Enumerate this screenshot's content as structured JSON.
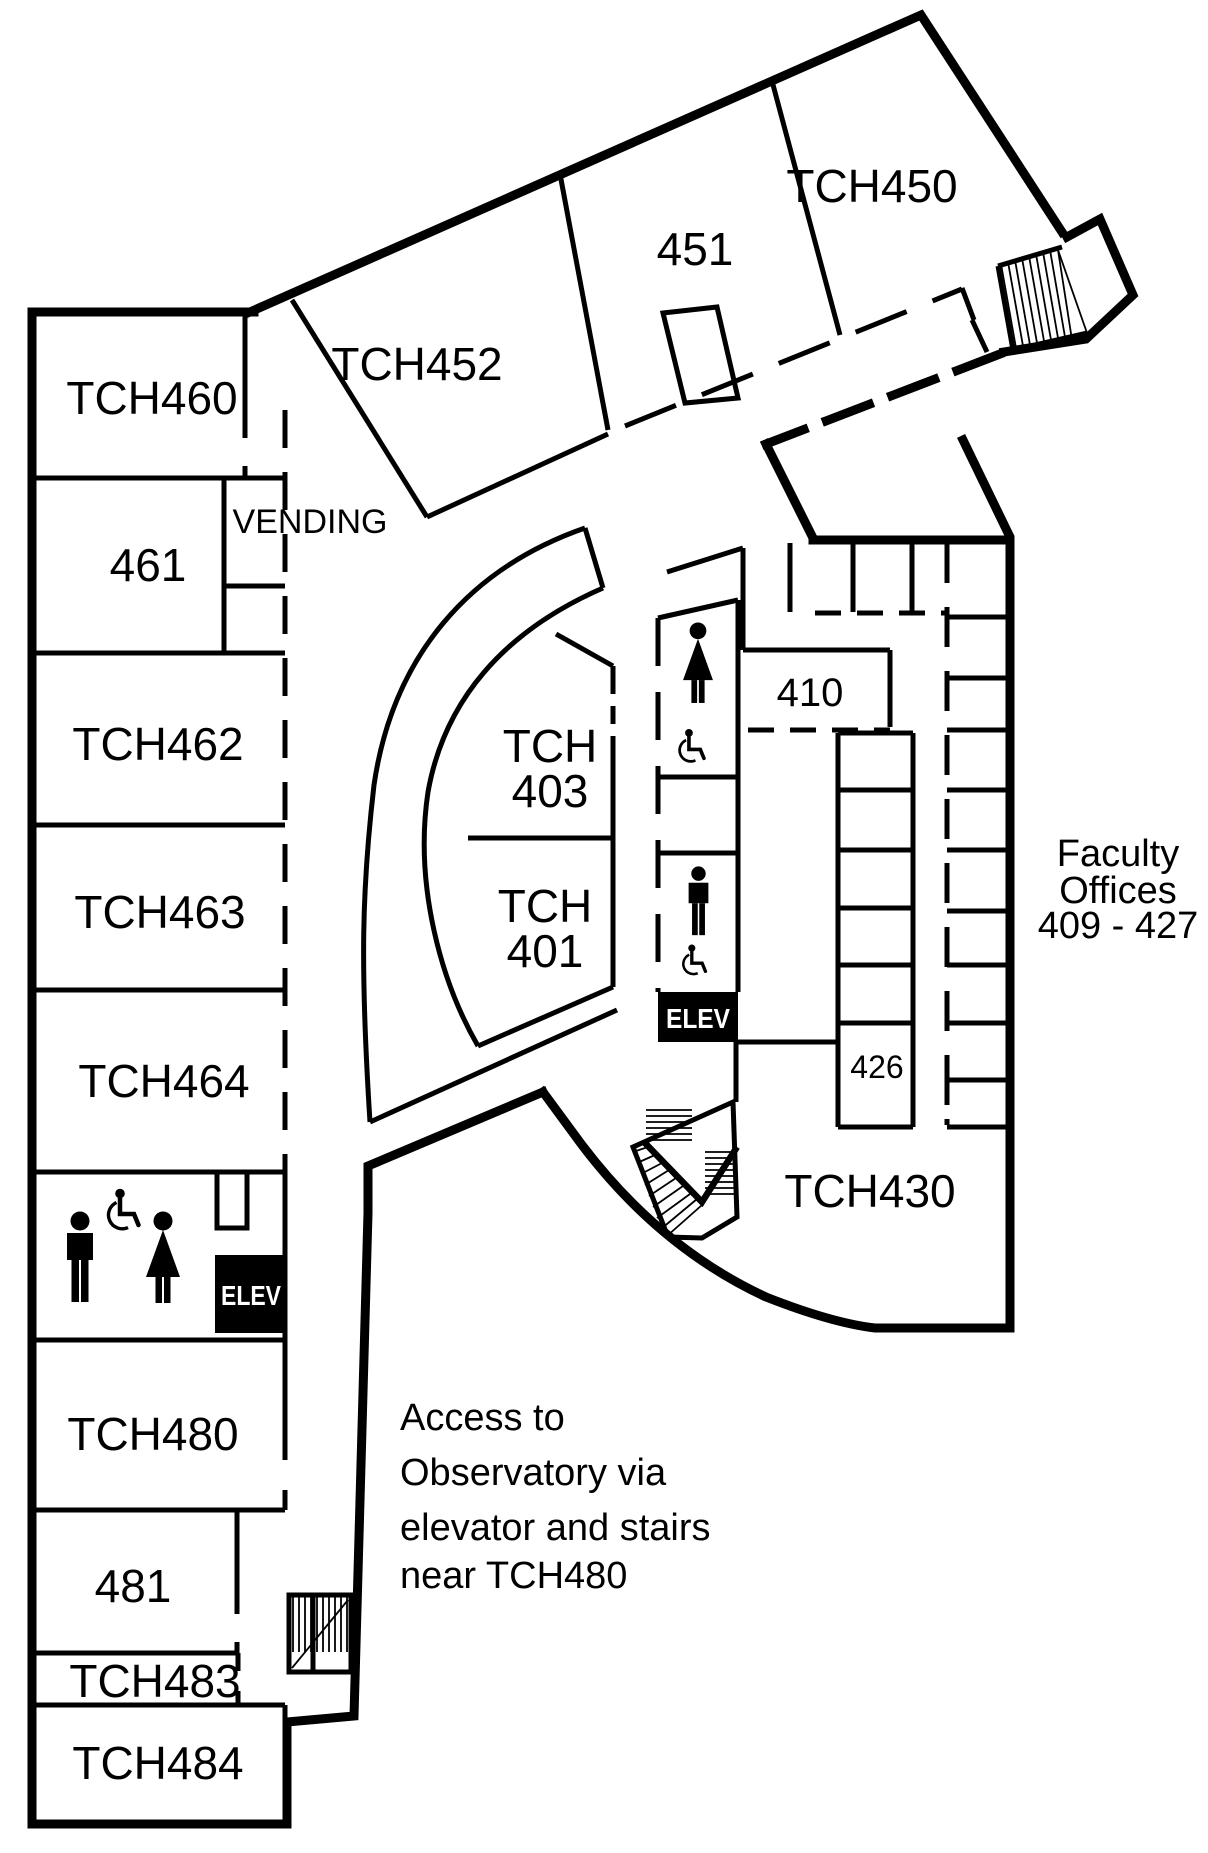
{
  "colors": {
    "ink": "#000000",
    "paper": "#ffffff",
    "elevator_bg": "#000000",
    "elevator_text": "#ffffff"
  },
  "rooms": {
    "tch460": "TCH460",
    "r461": "461",
    "tch462": "TCH462",
    "tch463": "TCH463",
    "tch464": "TCH464",
    "tch480": "TCH480",
    "r481": "481",
    "tch483": "TCH483",
    "tch484": "TCH484",
    "tch452": "TCH452",
    "r451": "451",
    "tch450": "TCH450",
    "tch403_line1": "TCH",
    "tch403_line2": "403",
    "tch401_line1": "TCH",
    "tch401_line2": "401",
    "r410": "410",
    "r426": "426",
    "tch430": "TCH430"
  },
  "labels": {
    "vending": "VENDING",
    "elevator": "ELEV",
    "faculty_offices_line1": "Faculty",
    "faculty_offices_line2": "Offices",
    "faculty_offices_line3": "409 - 427",
    "observatory_note_line1": "Access to",
    "observatory_note_line2": "Observatory via",
    "observatory_note_line3": "elevator and stairs",
    "observatory_note_line4": "near TCH480"
  },
  "icons": {
    "men_restroom": "men-restroom-icon",
    "women_restroom": "women-restroom-icon",
    "accessible": "accessible-icon",
    "stairs": "stairs-hatching",
    "elevator": "elevator-box"
  }
}
